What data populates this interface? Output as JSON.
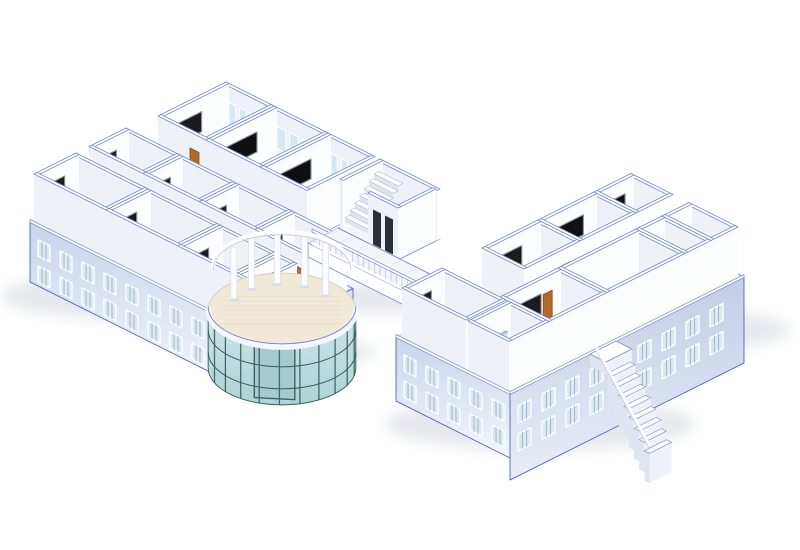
{
  "colors": {
    "line": "#7c90c6",
    "edge": "#5d73b4",
    "wallTop": "#ffffff",
    "wallLit": "#fcfdfe",
    "wallShade": "#eef1f7",
    "slab": "#f3f5f9",
    "tile": "#e1e6ef",
    "corridor": "#eaedf4",
    "floor": "#f6f7fa",
    "facadeSW": "#c8d3ed",
    "facadeSE": "#dce3f3",
    "facadeSE2": "#c2cde8",
    "facadeFade": "#f5f7fb",
    "winGlass": "#dce9f2",
    "winSlat": "#9db3c8",
    "winFrame": "#ffffff",
    "backWin": "#d6e8f3",
    "door": "#b06a2a",
    "doorDark": "#8a4c16",
    "board": "#1b1b1d",
    "boardDark": "#101012",
    "boardFrame": "#8f9499",
    "deskTop": "#f2b368",
    "deskSide": "#d9984b",
    "deskDark": "#c07c36",
    "chairTop": "#e8a24e",
    "chairSide": "#cd8840",
    "chairDark": "#b3722f",
    "tdeskTop": "#7a4524",
    "tdeskSide": "#5f3418",
    "tdeskDark": "#46250f",
    "tierTop": "#9a572c",
    "tierSide": "#7a3e1c",
    "tierDark": "#54290f",
    "labDeskTop": "#dca74e",
    "labDeskSide": "#b9812f",
    "labChair": "#2a2a2c",
    "labChairDark": "#151517",
    "officeFloor": "#faf4cb",
    "officeGlow": "#fffbe2",
    "offDeskTop": "#ead29b",
    "offDeskSide": "#c9a769",
    "monitor": "#28394e",
    "redChair": "#d23a28",
    "redChairDark": "#a32a1a",
    "plant": "#2f8f3c",
    "plantDark": "#1f6b2a",
    "pot": "#8a5a2e",
    "bathFloor": "#eaf2f8",
    "glass": "#cfe3f0",
    "glassTop": "#e8f2f8",
    "glassEdge": "#9fc0d8",
    "matYellow": "#f2ec9b",
    "elevDoor": "#2b2f38",
    "stairSide": "#dfe5f0",
    "stairTread": "#ffffff",
    "mullion": "#3c5b58",
    "glassA": "#cde7e8",
    "glassB": "#a9d2d5",
    "atriumFloor": "#f0e9d8",
    "atriumEdge": "#d8d1bd",
    "column": "#fbfcfe",
    "columnShade": "#dde3ee",
    "balusterLine": "#c9d2e2",
    "shadow": "#33486e"
  },
  "scene": {
    "projection": {
      "ox": 30,
      "oy": 222,
      "wallHeight": 50
    },
    "topblock": {
      "slab": {
        "u": 5,
        "v": 95,
        "w": 155,
        "d": 98
      },
      "corridor": {
        "u": 5,
        "v": 95,
        "w": 155,
        "d": 23
      },
      "rooms": [
        {
          "id": "t1",
          "type": "classroom",
          "u": 8,
          "v": 120,
          "w": 48,
          "d": 68,
          "winBack": true,
          "doorFront": true
        },
        {
          "id": "t2",
          "type": "tiered",
          "u": 56,
          "v": 120,
          "w": 54,
          "d": 68,
          "winBack": true
        },
        {
          "id": "t3",
          "type": "tiered",
          "u": 110,
          "v": 120,
          "w": 47,
          "d": 68,
          "winBack": true
        }
      ],
      "gapFacade": {
        "u": 160,
        "v0": 95,
        "v1": 193,
        "depth": 54
      }
    },
    "wing1": {
      "slab": {
        "u": 0,
        "v": 0,
        "w": 228,
        "d": 95
      },
      "corridor": {
        "u": 2,
        "v": 42,
        "w": 224,
        "d": 13
      },
      "backRooms": [
        {
          "id": "b1",
          "type": "classroom",
          "u": 4,
          "v": 55,
          "w": 54,
          "d": 37,
          "doorFront": true
        },
        {
          "id": "b2",
          "type": "classroom",
          "u": 58,
          "v": 55,
          "w": 56,
          "d": 37,
          "doorFront": true
        },
        {
          "id": "b3",
          "type": "classroom",
          "u": 114,
          "v": 55,
          "w": 56,
          "d": 37,
          "doorFront": true
        },
        {
          "id": "b4",
          "type": "classroom",
          "u": 170,
          "v": 55,
          "w": 55,
          "d": 37,
          "doorFront": true
        }
      ],
      "frontRooms": [
        {
          "id": "a1",
          "type": "classroom",
          "u": 4,
          "v": 0,
          "w": 72,
          "d": 42,
          "doorBack": true
        },
        {
          "id": "a2",
          "type": "classroom",
          "u": 76,
          "v": 0,
          "w": 72,
          "d": 42,
          "doorBack": true
        },
        {
          "id": "a3",
          "type": "classroom",
          "u": 148,
          "v": 0,
          "w": 57,
          "d": 42,
          "doorBack": true
        },
        {
          "id": "a4",
          "type": "vestibule",
          "u": 205,
          "v": 0,
          "w": 20,
          "d": 42
        }
      ],
      "facade": {
        "u0": 0,
        "u1": 228,
        "v": 0,
        "depth": 60,
        "rows": 2
      },
      "endFacade": {
        "u": 228,
        "v0": 0,
        "v1": 95,
        "depth": 58
      }
    },
    "bridge": {
      "floor": {
        "u": 160,
        "v": 118,
        "w": 142,
        "d": 30
      },
      "fasciaDepth": 14,
      "balustrade": {
        "u0": 164,
        "u1": 296,
        "v": 118
      }
    },
    "stairblock": {
      "slab": {
        "u": 162,
        "v": 148,
        "w": 60,
        "d": 40
      },
      "stair": {
        "u": 164,
        "v": 151,
        "w": 24,
        "d": 34,
        "steps": 7
      },
      "elevator": {
        "u": 190,
        "v": 148,
        "w": 30,
        "d": 38
      }
    },
    "wing2": {
      "slab": {
        "u": 298,
        "v": 68,
        "w": 114,
        "d": 234
      },
      "corridor": {
        "u": 344,
        "v": 110,
        "w": 16,
        "d": 192
      },
      "col1": [
        {
          "id": "c3",
          "type": "tiered",
          "u": 302,
          "v": 262,
          "w": 42,
          "d": 37
        },
        {
          "id": "c2",
          "type": "tiered",
          "u": 302,
          "v": 206,
          "w": 42,
          "d": 56
        },
        {
          "id": "c1",
          "type": "classroom",
          "u": 302,
          "v": 150,
          "w": 42,
          "d": 56,
          "doorRight": true
        }
      ],
      "col2": [
        {
          "id": "d4",
          "type": "office",
          "u": 360,
          "v": 272,
          "w": 49,
          "d": 27
        },
        {
          "id": "d3",
          "type": "office",
          "u": 360,
          "v": 246,
          "w": 49,
          "d": 26
        },
        {
          "id": "d2",
          "type": "lab",
          "u": 360,
          "v": 168,
          "w": 49,
          "d": 78
        },
        {
          "id": "d1",
          "type": "classroom",
          "u": 360,
          "v": 110,
          "w": 49,
          "d": 58,
          "doorLeft": true
        }
      ],
      "endRooms": [
        {
          "id": "e1",
          "type": "classroom",
          "u": 302,
          "v": 70,
          "w": 64,
          "d": 40
        },
        {
          "id": "e2",
          "type": "bath",
          "u": 368,
          "v": 70,
          "w": 41,
          "d": 40
        }
      ],
      "facadeSE": {
        "u": 412,
        "v0": 68,
        "v1": 302,
        "depth": 86,
        "rows": 2
      },
      "facadeSW": {
        "u0": 298,
        "u1": 412,
        "v": 68,
        "depth": 64,
        "rows": 2
      },
      "extStair": {
        "u": 412,
        "v": 148,
        "d": 26,
        "steps": 8
      }
    },
    "rotunda": {
      "u": 214,
      "v": 38,
      "r": 52,
      "depth": 58,
      "mullionStart": 12,
      "mullionEnd": 170,
      "mullionStep": 16,
      "columnAngles": [
        205,
        235,
        265,
        295,
        325
      ]
    },
    "shadows": [
      {
        "cx": 150,
        "cy": 296,
        "rx": 150,
        "ry": 24
      },
      {
        "cx": 282,
        "cy": 352,
        "rx": 92,
        "ry": 15
      },
      {
        "cx": 392,
        "cy": 298,
        "rx": 92,
        "ry": 15
      },
      {
        "cx": 540,
        "cy": 424,
        "rx": 155,
        "ry": 26
      },
      {
        "cx": 695,
        "cy": 330,
        "rx": 95,
        "ry": 19
      }
    ]
  }
}
